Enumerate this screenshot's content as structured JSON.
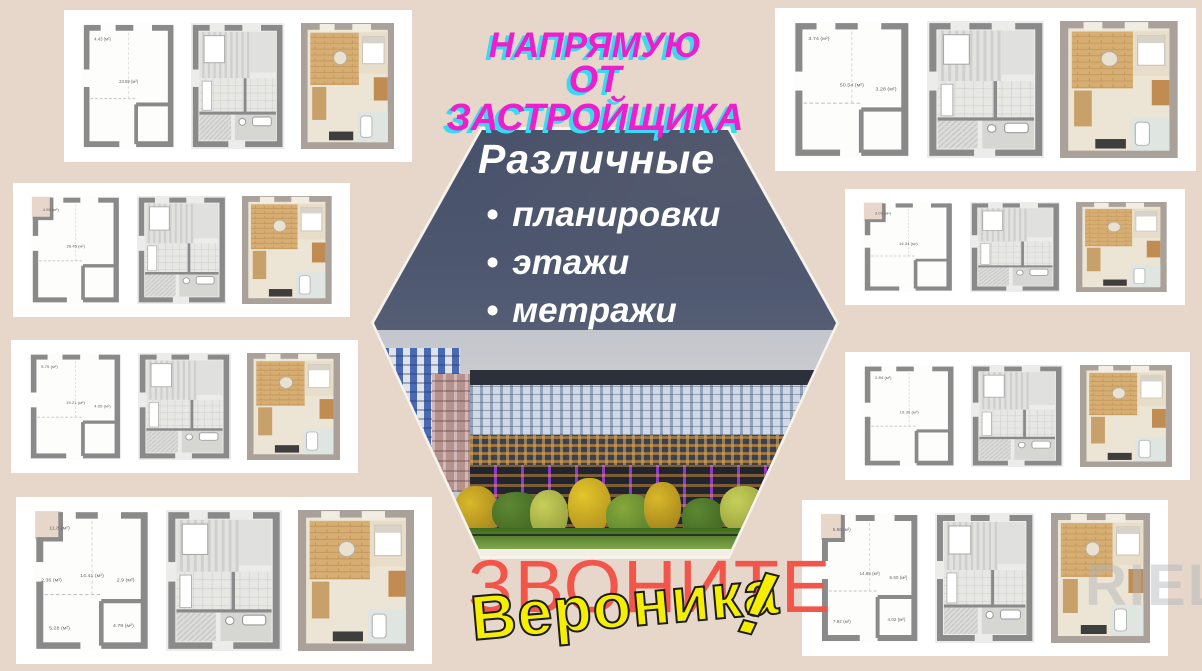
{
  "colors": {
    "background": "#e6d7ca",
    "headline_magenta": "#ef1ecb",
    "headline_cyan": "#38d9f2",
    "call_red": "#f2564a",
    "name_yellow": "#f5ee00",
    "overlay_blue": "#38425c",
    "plan_wall_gray": "#8a8a8a"
  },
  "headline": {
    "line1": "НАПРЯМУЮ",
    "line2": "ОТ ЗАСТРОЙЩИКА"
  },
  "hexagon": {
    "title": "Различные",
    "bullet_char": "•",
    "bullets": [
      "планировки",
      "этажи",
      "метражи"
    ]
  },
  "call_to_action": {
    "text": "ЗВОНИТЕ"
  },
  "contact": {
    "name": "Вероника",
    "exclamation": "!"
  },
  "watermark": {
    "text": "RIEL"
  },
  "floor_plan_cards": [
    {
      "id": "top-left",
      "plans": [
        {
          "kind": "outline",
          "area_labels": [
            "23.59 (м²)",
            "4.43 (м²)"
          ]
        },
        {
          "kind": "technical",
          "area_labels": []
        },
        {
          "kind": "render",
          "area_labels": []
        }
      ]
    },
    {
      "id": "left-upper",
      "plans": [
        {
          "kind": "outline",
          "area_labels": [
            "28.45 (м²)",
            "4.95 (м²)"
          ]
        },
        {
          "kind": "technical",
          "area_labels": []
        },
        {
          "kind": "render",
          "area_labels": []
        }
      ]
    },
    {
      "id": "left-lower",
      "plans": [
        {
          "kind": "outline",
          "area_labels": [
            "19.21 (м²)",
            "5.75 (м²)",
            "4.09 (м²)"
          ]
        },
        {
          "kind": "technical",
          "area_labels": []
        },
        {
          "kind": "render",
          "area_labels": []
        }
      ]
    },
    {
      "id": "bottom-left",
      "plans": [
        {
          "kind": "outline",
          "area_labels": [
            "14.41 (м²)",
            "11.8 (м²)",
            "2.9 (м²)",
            "4.79 (м²)",
            "5.28 (м²)",
            "2.36 (м²)"
          ]
        },
        {
          "kind": "technical",
          "area_labels": []
        },
        {
          "kind": "render",
          "area_labels": []
        }
      ]
    },
    {
      "id": "top-right",
      "plans": [
        {
          "kind": "outline",
          "area_labels": [
            "50.54 (м²)",
            "3.74 (м²)",
            "3.28 (м²)"
          ]
        },
        {
          "kind": "technical",
          "area_labels": []
        },
        {
          "kind": "render",
          "area_labels": []
        }
      ]
    },
    {
      "id": "right-upper",
      "plans": [
        {
          "kind": "outline",
          "area_labels": [
            "16.34 (м²)",
            "3.09 (м²)"
          ]
        },
        {
          "kind": "technical",
          "area_labels": []
        },
        {
          "kind": "render",
          "area_labels": []
        }
      ]
    },
    {
      "id": "right-lower",
      "plans": [
        {
          "kind": "outline",
          "area_labels": [
            "19.30 (м²)",
            "2.84 (м²)"
          ]
        },
        {
          "kind": "technical",
          "area_labels": []
        },
        {
          "kind": "render",
          "area_labels": []
        }
      ]
    },
    {
      "id": "bottom-right",
      "plans": [
        {
          "kind": "outline",
          "area_labels": [
            "14.85 (м²)",
            "5.56 (м²)",
            "5.50 (м²)",
            "4.02 (м²)",
            "7.92 (м²)"
          ]
        },
        {
          "kind": "technical",
          "area_labels": []
        },
        {
          "kind": "render",
          "area_labels": []
        }
      ]
    }
  ]
}
